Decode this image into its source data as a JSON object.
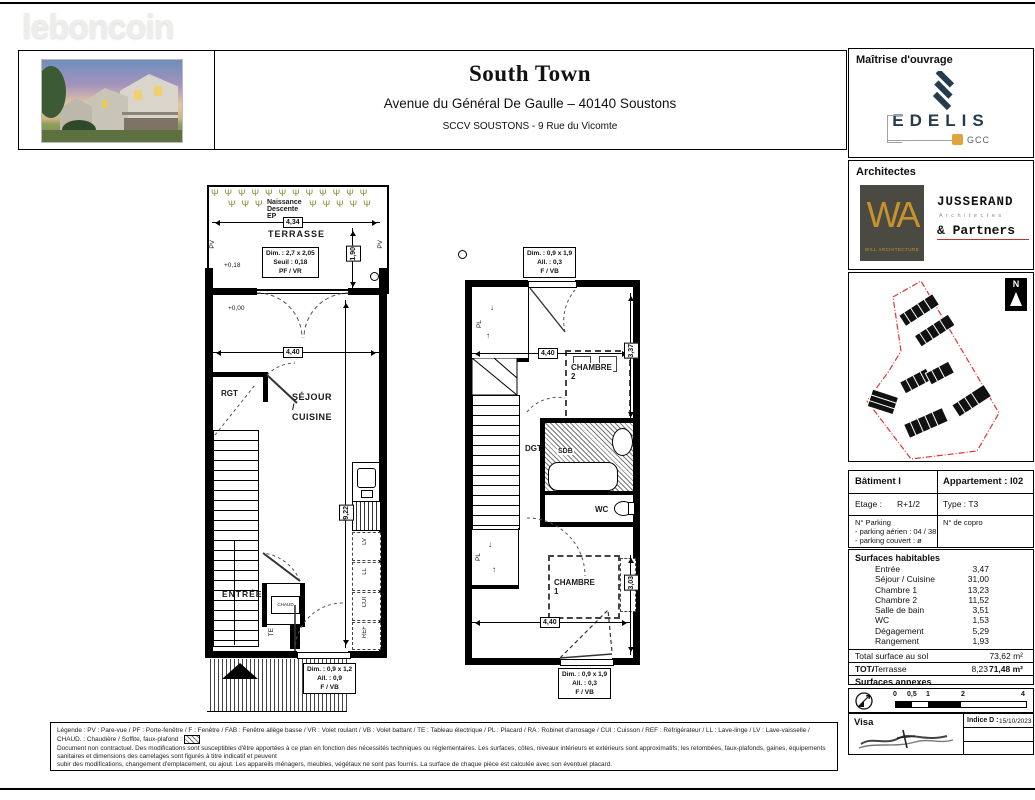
{
  "watermark": "leboncoin",
  "header": {
    "title": "South Town",
    "address": "Avenue du Général De Gaulle – 40140 Soustons",
    "company": "SCCV SOUSTONS - 9 Rue du Vicomte"
  },
  "colors": {
    "edelis_navy": "#253c4e",
    "gold": "#c8922a",
    "site_boundary_red": "#e03535",
    "plant_olive": "#8a8a2e"
  },
  "sidebar": {
    "maitrise_label": "Maîtrise d'ouvrage",
    "edelis_name": "EDELIS",
    "edelis_sub": "GCC",
    "architectes_label": "Architectes",
    "wa_monogram": "WA",
    "wa_sub": "WILL ARCHITECTURE",
    "jusserand_1": "JUSSERAND",
    "jusserand_2": "A r c h i t e c t e s",
    "jusserand_3": "& Partners",
    "north_letter": "N",
    "table": {
      "batiment": "Bâtiment I",
      "appartement": "Appartement : I02",
      "etage_label": "Etage :",
      "etage_value": "R+1/2",
      "type": "Type : T3",
      "parking_title": "N° Parking",
      "parking_aerien": "- parking aérien : 04 / 38",
      "parking_couvert": "- parking couvert :  ø",
      "copro": "N° de copro"
    },
    "surfaces": {
      "title": "Surfaces habitables",
      "rows": [
        {
          "label": "Entrée",
          "value": "3,47"
        },
        {
          "label": "Séjour / Cuisine",
          "value": "31,00"
        },
        {
          "label": "Chambre 1",
          "value": "13,23"
        },
        {
          "label": "Chambre 2",
          "value": "11,52"
        },
        {
          "label": "Salle de bain",
          "value": "3,51"
        },
        {
          "label": "WC",
          "value": "1,53"
        },
        {
          "label": "Dégagement",
          "value": "5,29"
        },
        {
          "label": "Rangement",
          "value": "1,93"
        }
      ],
      "total_label": "Total surface au sol",
      "total_value": "73,62 m²",
      "shab_label": "TOTAL SHAB",
      "shab_value": "71,48 m²",
      "annexes_title": "Surfaces annexes",
      "annexe_label": "Terrasse",
      "annexe_value": "8,23"
    },
    "scale_ticks": [
      "0",
      "0,5",
      "1",
      "2",
      "4"
    ],
    "visa_label": "Visa",
    "indice_label": "Indice D :",
    "indice_date": "15/10/2023"
  },
  "plan_left": {
    "naissance": "Naissance Descente EP",
    "dim_434": "4,34",
    "terrasse": "TERRASSE",
    "dim_190": "1,90",
    "win_terrasse": {
      "l1": "Dim. : 2,7 x 2,05",
      "l2": "Seuil : 0,18",
      "l3": "PF / VR"
    },
    "lvl_018": "+0,18",
    "lvl_000": "+0,00",
    "pv": "PV",
    "dim_440": "4,40",
    "rgt": "RGT",
    "sejour": "SÉJOUR / CUISINE",
    "dim_922": "9,22",
    "entree": "ENTRÉE",
    "chaud": "CHAUD",
    "te": "TE",
    "kitchen": [
      "LV",
      "LL",
      "CUI",
      "REF"
    ],
    "win_bottom": {
      "l1": "Dim. : 0,9 x 1,2",
      "l2": "All. : 0,9",
      "l3": "F / VB"
    }
  },
  "plan_right": {
    "win_top": {
      "l1": "Dim. : 0,9 x 1,9",
      "l2": "All. : 0,3",
      "l3": "F / VB"
    },
    "dim_440_top": "4,40",
    "pl": "PL",
    "chambre2": "CHAMBRE 2",
    "dim_337": "3,37",
    "dgt": "DGT.",
    "sdb": "SDB",
    "wc": "WC",
    "chambre1": "CHAMBRE 1",
    "dim_303": "3,03",
    "dim_440_bottom": "4,40",
    "win_bottom": {
      "l1": "Dim. : 0,9 x 1,9",
      "l2": "All. : 0,3",
      "l3": "F / VB"
    }
  },
  "legend": {
    "line1": "Légende : PV : Pare-vue / PF : Porte-fenêtre / F : Fenêtre / FAB : Fenêtre allège basse / VR : Volet roulant / VB : Volet battant / TE : Tableau électrique / PL : Placard / RA : Robinet d'arrosage / CUI : Cuisson / REF : Réfrigérateur / LL : Lave-linge / LV : Lave-vaisselle / CHAUD. : Chaudière      / Soffite, faux-plafond :",
    "line2": "Document non contractuel. Des modifications sont susceptibles d'être apportées à ce plan en fonction des nécessités techniques ou réglementaires. Les surfaces, côtes, niveaux intérieurs et extérieurs sont approximatifs; les retombées, faux-plafonds, gaines, équipements sanitaires et dimensions des carrelages sont figurés à titre indicatif et peuvent",
    "line3": "subir des modifications, changement d'emplacement, ou ajout. Les appareils ménagers, meubles, végétaux ne sont pas fournis. La surface de chaque pièce est calculée avec son éventuel placard."
  }
}
